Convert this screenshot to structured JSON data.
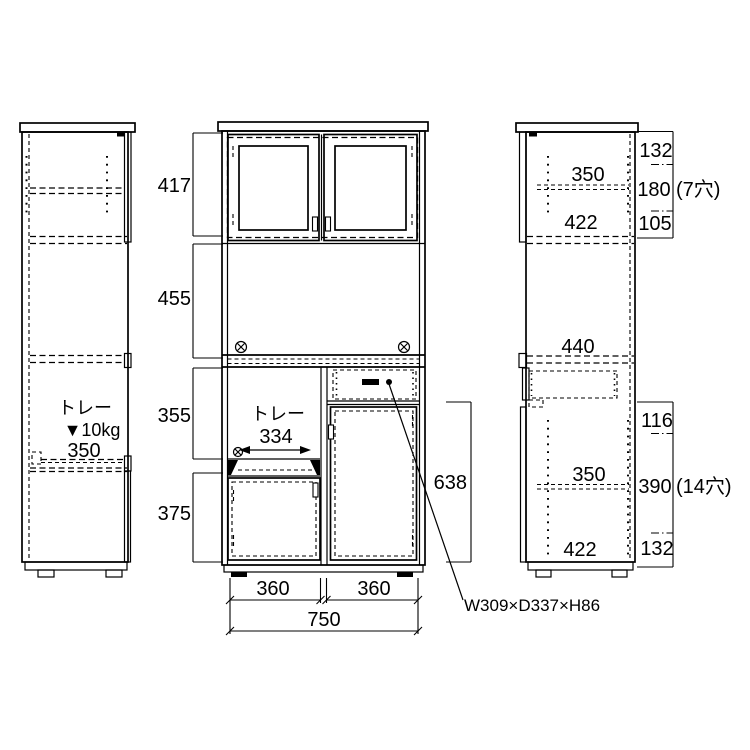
{
  "colors": {
    "background": "#ffffff",
    "line": "#000000"
  },
  "left_view": {
    "tray_label": "トレー",
    "tray_capacity": "▼10kg",
    "tray_width": "350"
  },
  "center_view": {
    "height_top_cabinet": "417",
    "height_open_section": "455",
    "height_niche": "355",
    "height_door": "375",
    "niche_tray_label": "トレー",
    "niche_tray_width": "334",
    "width_left": "360",
    "width_right": "360",
    "width_total": "750",
    "height_counter_to_floor": "638",
    "drawer_note": "W309×D337×H86"
  },
  "right_view": {
    "upper": {
      "shelf_width": "350",
      "inner_width": "422",
      "seg_top": "132",
      "seg_mid": "180",
      "seg_bottom": "105",
      "holes": "(7穴)"
    },
    "lower": {
      "inner_top_width": "440",
      "shelf_width": "350",
      "inner_width": "422",
      "seg_top": "116",
      "seg_mid": "390",
      "seg_bottom": "132",
      "holes": "(14穴)"
    }
  }
}
